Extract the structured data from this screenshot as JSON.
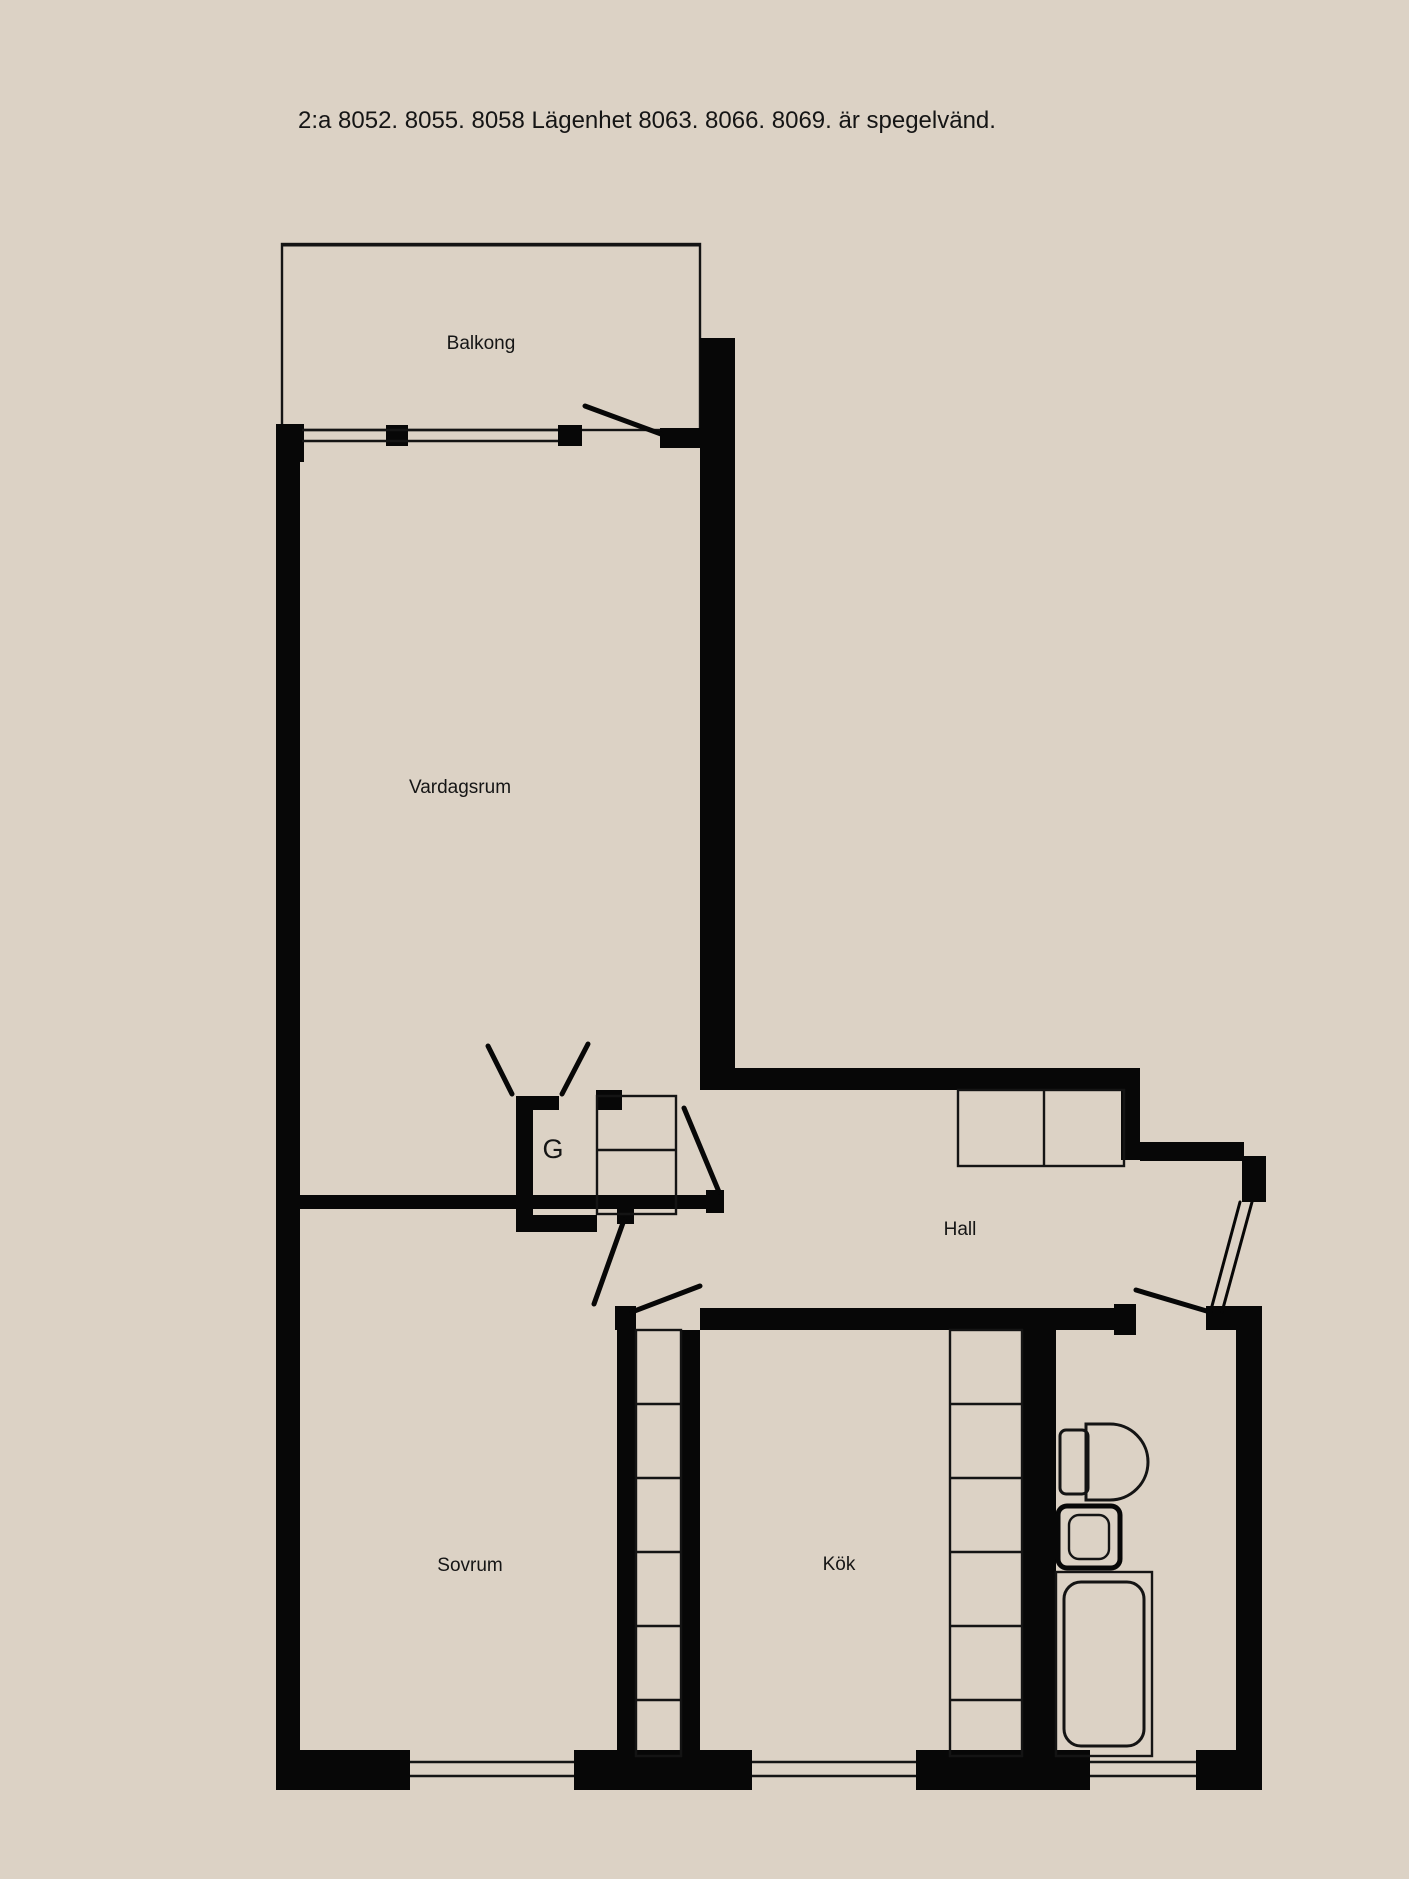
{
  "title": "2:a  8052. 8055. 8058 Lägenhet 8063. 8066. 8069. är spegelvänd.",
  "rooms": {
    "balcony": "Balkong",
    "living_room": "Vardagsrum",
    "hall": "Hall",
    "closet": "G",
    "bedroom": "Sovrum",
    "kitchen": "Kök",
    "bathroom": "Bad"
  },
  "colors": {
    "background": "#dcd2c5",
    "walls": "#070707",
    "labels": "#151515"
  }
}
